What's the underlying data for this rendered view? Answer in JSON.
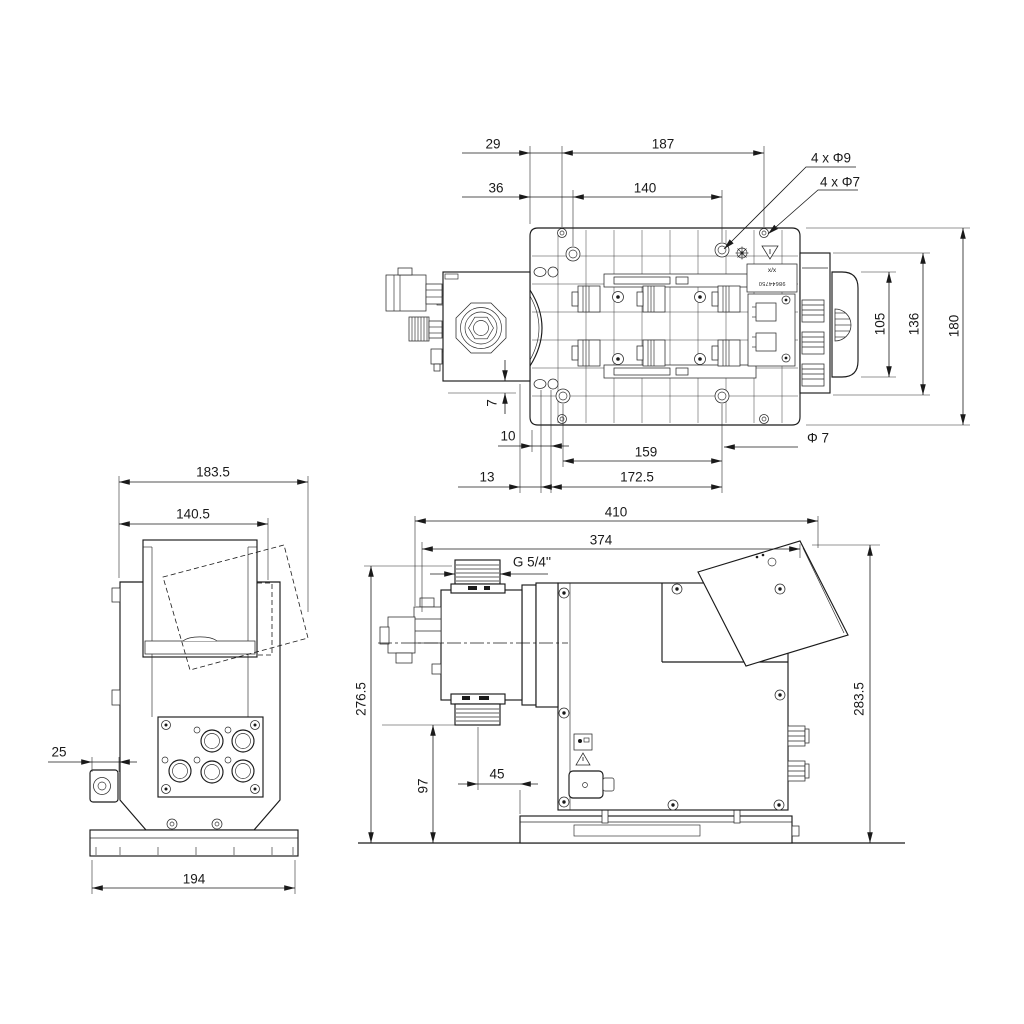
{
  "colors": {
    "background": "#ffffff",
    "line": "#1a1a1a"
  },
  "views": {
    "top": {
      "dims": {
        "d29": "29",
        "d187": "187",
        "d36": "36",
        "d140": "140",
        "holes9": "4 x Φ9",
        "holes7": "4 x Φ7",
        "d105": "105",
        "d136": "136",
        "d180": "180",
        "d7": "7",
        "d10": "10",
        "d159": "159",
        "phi7": "Φ 7",
        "d13": "13",
        "d172_5": "172.5"
      },
      "plate_label": {
        "line1": "x/x",
        "line2": "98644750"
      }
    },
    "front": {
      "dims": {
        "d183_5": "183.5",
        "d140_5": "140.5",
        "d25": "25",
        "d194": "194"
      }
    },
    "side": {
      "dims": {
        "d410": "410",
        "d374": "374",
        "thread": "G 5/4''",
        "d276_5": "276.5",
        "d97": "97",
        "d45": "45",
        "d283_5": "283.5"
      }
    }
  }
}
